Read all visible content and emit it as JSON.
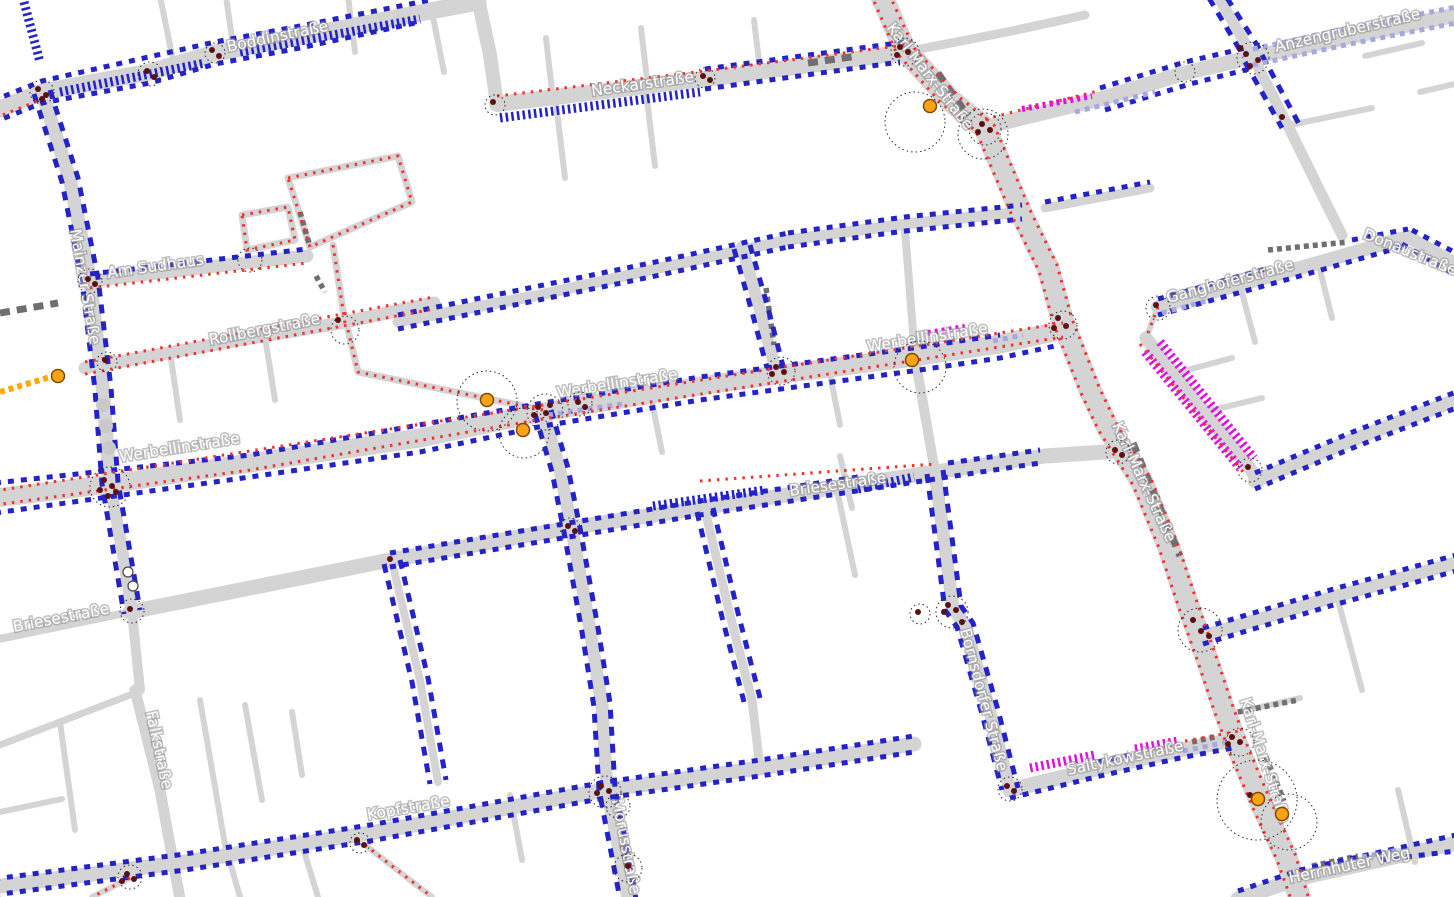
{
  "map": {
    "street_labels": {
      "karl_marx_strasse": "Karl-Marx-Straße",
      "werbellinstrasse": "Werbellinstraße",
      "anzengruberstrasse": "Anzengruberstraße",
      "boddinstrasse": "Boddinstraße",
      "neckarstrasse": "Neckarstraße",
      "mainzer_strasse": "Mainzer Straße",
      "am_sudhaus": "Am Sudhaus",
      "rollbergstrasse": "Rollbergstraße",
      "briesestrasse": "Briesestraße",
      "falkstrasse": "Falkstraße",
      "kopfstrasse": "Kopfstraße",
      "morusstrasse": "Morusstraße",
      "bornsdorfer_strasse": "Bornsdorfer Straße",
      "saltykowstrasse": "Saltykowstraße",
      "herrnhuter_weg": "Herrnhuter Weg",
      "ganghoferstrasse": "Ganghoferstraße",
      "donaustrasse": "Donaustraße"
    },
    "colors": {
      "road": "#d4d4d4",
      "red": "#f53030",
      "blue": "#2323c8",
      "lavender": "#a8a8e0",
      "magenta": "#e010e0",
      "darkgray": "#6f6f6f",
      "orangedash": "#ffaa00",
      "nodedark": "#5a1111",
      "nodeorange": "#ffa316",
      "treegray": "#c9c9c9"
    }
  }
}
